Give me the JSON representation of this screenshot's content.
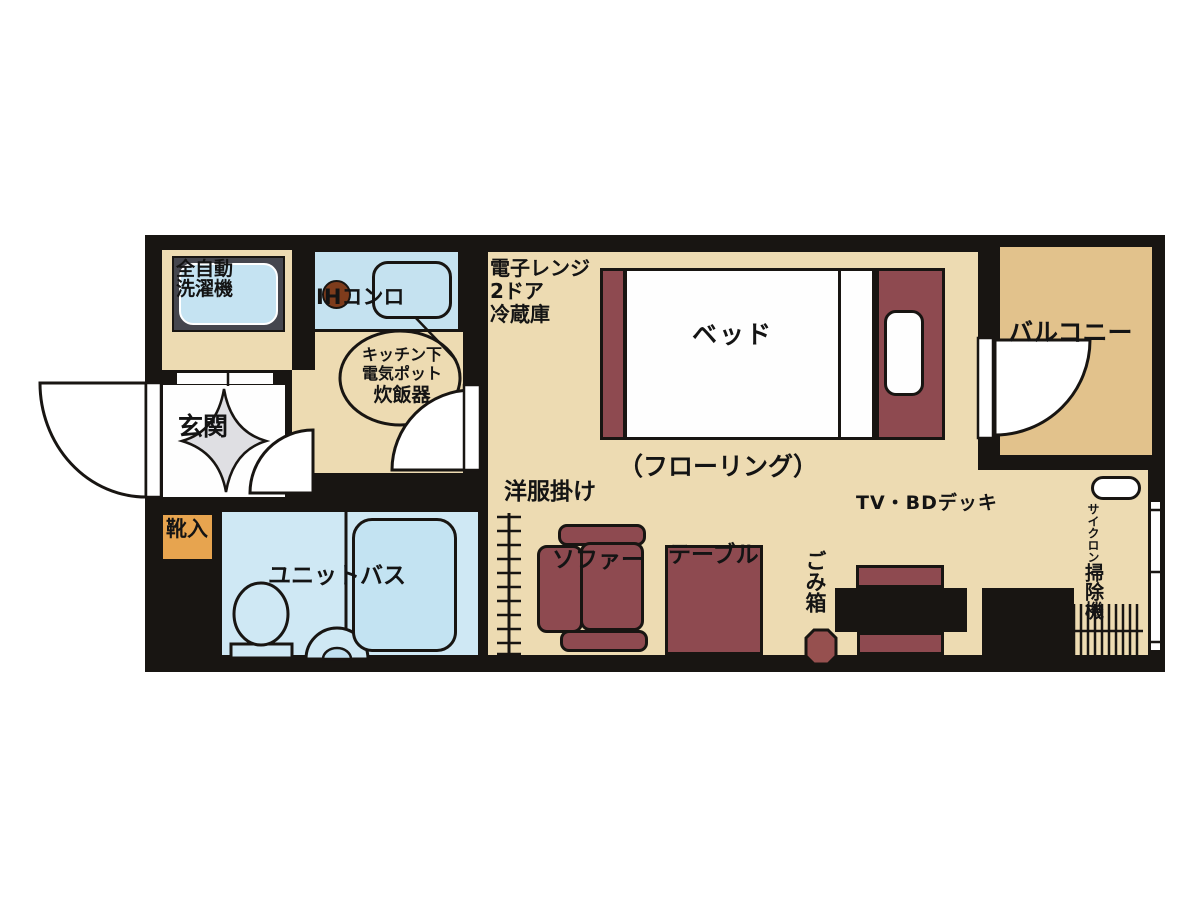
{
  "plan": {
    "type": "japanese-apartment-floorplan",
    "labels": {
      "washer": [
        "全自動",
        "洗濯機"
      ],
      "ih_stove": "IHコンロ",
      "kitchen_under": [
        "キッチン下",
        "電気ポット",
        "炊飯器"
      ],
      "fridge": [
        "電子レンジ",
        "2ドア",
        "冷蔵庫"
      ],
      "bed": "ベッド",
      "balcony": "バルコニー",
      "entrance": "玄関",
      "shoe_box": "靴入",
      "unit_bath": "ユニットバス",
      "flooring": "（フローリング）",
      "hanger": "洋服掛け",
      "sofa": "ソファー",
      "table": "テーブル",
      "tv": "TV・BDデッキ",
      "trash": "ごみ箱",
      "vacuum_type": "サイクロン",
      "vacuum": "掃除機"
    },
    "colors": {
      "wall": "#181512",
      "floor_main": "#eddbb2",
      "floor_balcony": "#e2c28c",
      "kitchen_counter_blue": "#c5e2f0",
      "bath_blue": "#cfe8f4",
      "bathtub_blue": "#c3e3f2",
      "furniture_maroon": "#8e4a50",
      "burner_brown": "#7e3c1c",
      "shoe_box_orange": "#e7a44f",
      "entrance_gray": "#dfdfe3",
      "washer_frame_gray": "#45464e"
    }
  }
}
